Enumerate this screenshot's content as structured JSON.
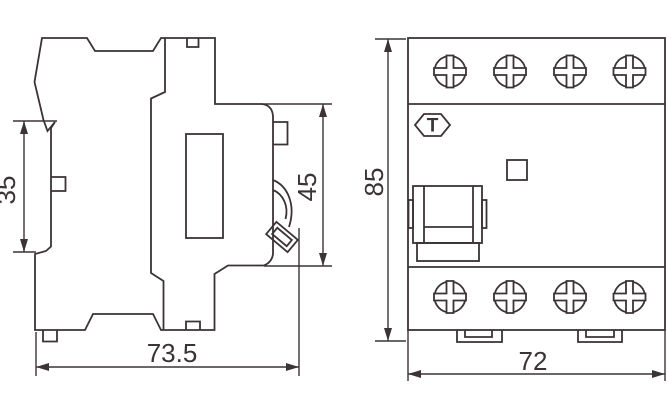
{
  "side_view": {
    "dim_rail_clip_height": "35",
    "dim_front_face_height": "45",
    "dim_depth": "73.5"
  },
  "front_view": {
    "test_button_label": "T",
    "dim_height": "85",
    "dim_width": "72"
  },
  "colors": {
    "line": "#3b3335",
    "background": "#ffffff"
  }
}
